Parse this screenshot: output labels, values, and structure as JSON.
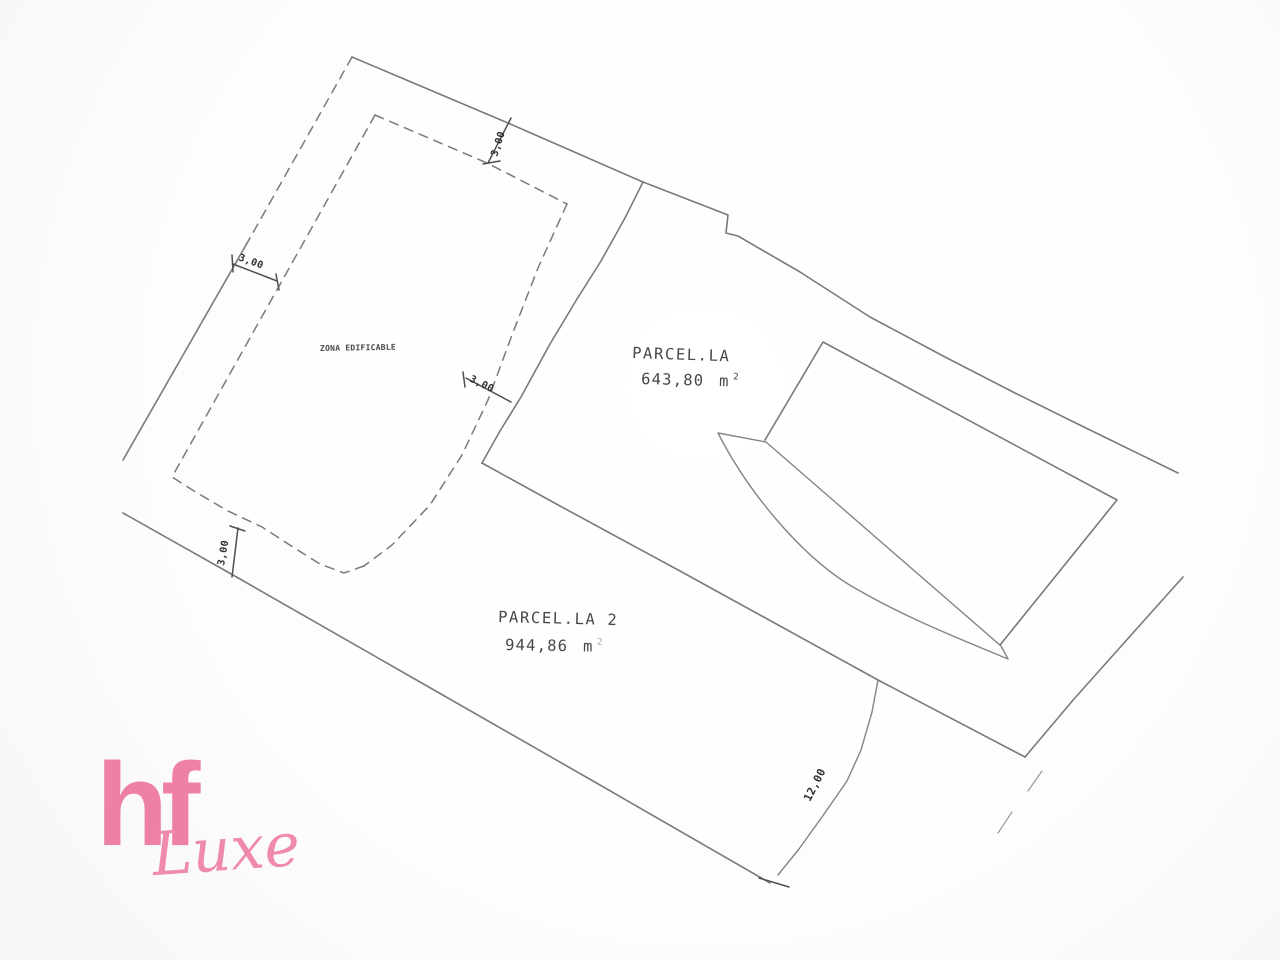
{
  "plan": {
    "zona_label": "ZONA EDIFICABLE",
    "parcels": [
      {
        "name": "PARCEL.LA",
        "area_value": "643,80",
        "area_unit": "m",
        "area_exp": "2"
      },
      {
        "name": "PARCEL.LA 2",
        "area_value": "944,86",
        "area_unit": "m",
        "area_exp": "2"
      }
    ],
    "dims": {
      "top": "3,00",
      "left": "3,00",
      "right": "3,00",
      "bottom": "3,00",
      "east": "12,00"
    }
  },
  "logo": {
    "hf": "hf",
    "luxe": "Luxe",
    "color": "#ee7fa6"
  }
}
